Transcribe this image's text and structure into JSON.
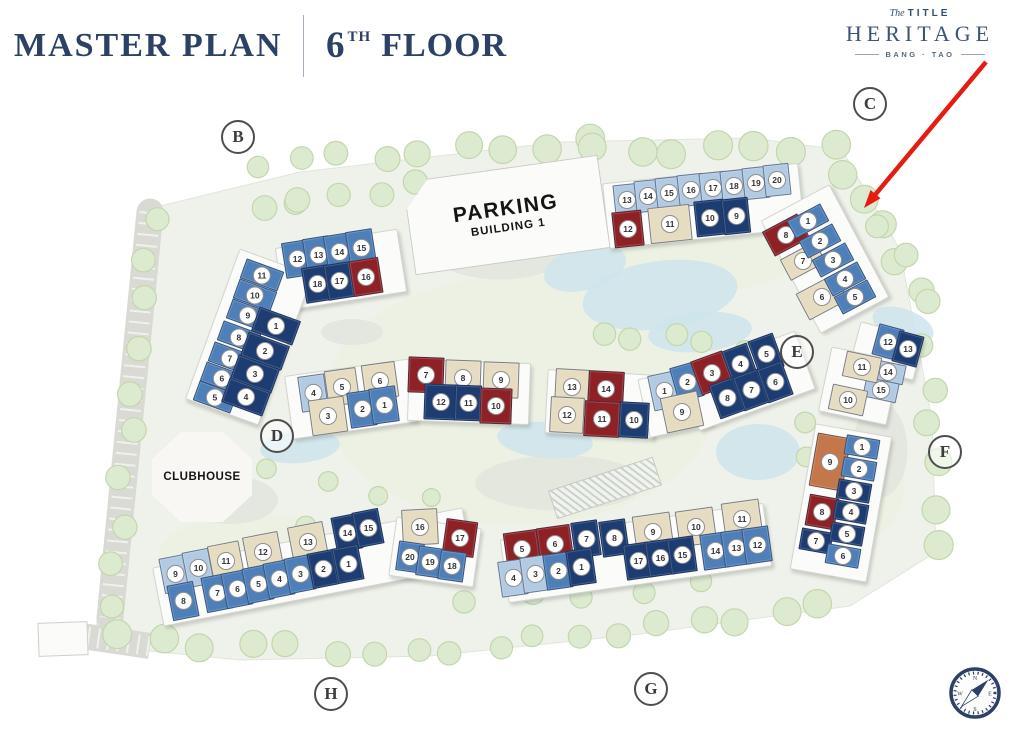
{
  "header": {
    "title": "MASTER PLAN",
    "floor_num": "6",
    "floor_sup": "TH",
    "floor_label": "FLOOR"
  },
  "logo": {
    "prefix": "The",
    "title": "TITLE",
    "name": "HERITAGE",
    "location": "BANG · TAO"
  },
  "site": {
    "parking": {
      "line1": "PARKING",
      "line2": "BUILDING 1"
    },
    "clubhouse": {
      "label": "CLUBHOUSE"
    },
    "status_colors": {
      "lb": "#b3cae3",
      "mb": "#4f7fb8",
      "db": "#1d3c72",
      "rd": "#8e2125",
      "bg": "#e6dcc2",
      "or": "#c3774a"
    },
    "markers": [
      {
        "letter": "B",
        "x": 238,
        "y": 137
      },
      {
        "letter": "C",
        "x": 870,
        "y": 104
      },
      {
        "letter": "D",
        "x": 277,
        "y": 436
      },
      {
        "letter": "E",
        "x": 797,
        "y": 352
      },
      {
        "letter": "F",
        "x": 945,
        "y": 452
      },
      {
        "letter": "G",
        "x": 651,
        "y": 689
      },
      {
        "letter": "H",
        "x": 331,
        "y": 694
      }
    ],
    "annotation_arrow": {
      "from": {
        "x": 986,
        "y": 62
      },
      "to": {
        "x": 864,
        "y": 208
      },
      "color": "#e51c10"
    },
    "compass": {
      "points": [
        "N",
        "E",
        "S",
        "W"
      ]
    },
    "buildings": [
      {
        "id": "B",
        "units": [
          {
            "n": "12",
            "x": 297,
            "y": 259,
            "c": "mb",
            "r": -9
          },
          {
            "n": "13",
            "x": 318,
            "y": 255,
            "c": "mb",
            "r": -9
          },
          {
            "n": "14",
            "x": 339,
            "y": 252,
            "c": "mb",
            "r": -9
          },
          {
            "n": "15",
            "x": 361,
            "y": 248,
            "c": "mb",
            "r": -9
          },
          {
            "n": "18",
            "x": 317,
            "y": 284,
            "c": "db",
            "r": -9
          },
          {
            "n": "17",
            "x": 339,
            "y": 281,
            "c": "db",
            "r": -9
          },
          {
            "n": "16",
            "x": 366,
            "y": 277,
            "c": "rd",
            "r": -9,
            "w": 30
          },
          {
            "n": "11",
            "x": 262,
            "y": 275,
            "c": "mb",
            "r": 20,
            "w": 40,
            "h": 21
          },
          {
            "n": "10",
            "x": 255,
            "y": 295,
            "c": "mb",
            "r": 20,
            "w": 40,
            "h": 21
          },
          {
            "n": "9",
            "x": 248,
            "y": 315,
            "c": "mb",
            "r": 20,
            "w": 40,
            "h": 21
          },
          {
            "n": "8",
            "x": 239,
            "y": 337,
            "c": "mb",
            "r": 20,
            "w": 40,
            "h": 21
          },
          {
            "n": "7",
            "x": 230,
            "y": 358,
            "c": "mb",
            "r": 20,
            "w": 40,
            "h": 21
          },
          {
            "n": "6",
            "x": 222,
            "y": 378,
            "c": "mb",
            "r": 20,
            "w": 40,
            "h": 21
          },
          {
            "n": "5",
            "x": 215,
            "y": 397,
            "c": "mb",
            "r": 20,
            "w": 40,
            "h": 21
          },
          {
            "n": "1",
            "x": 276,
            "y": 326,
            "c": "db",
            "r": 20,
            "w": 44,
            "h": 26
          },
          {
            "n": "2",
            "x": 265,
            "y": 351,
            "c": "db",
            "r": 20,
            "w": 44,
            "h": 26
          },
          {
            "n": "3",
            "x": 255,
            "y": 374,
            "c": "db",
            "r": 20,
            "w": 44,
            "h": 26
          },
          {
            "n": "4",
            "x": 246,
            "y": 397,
            "c": "db",
            "r": 20,
            "w": 44,
            "h": 26
          }
        ]
      },
      {
        "id": "C",
        "units": [
          {
            "n": "13",
            "x": 627,
            "y": 200,
            "c": "lb",
            "r": -6,
            "w": 26,
            "h": 32
          },
          {
            "n": "14",
            "x": 648,
            "y": 196,
            "c": "lb",
            "r": -6,
            "w": 26,
            "h": 32
          },
          {
            "n": "15",
            "x": 669,
            "y": 193,
            "c": "lb",
            "r": -6,
            "w": 26,
            "h": 32
          },
          {
            "n": "16",
            "x": 691,
            "y": 190,
            "c": "lb",
            "r": -6,
            "w": 26,
            "h": 32
          },
          {
            "n": "17",
            "x": 713,
            "y": 188,
            "c": "lb",
            "r": -6,
            "w": 26,
            "h": 32
          },
          {
            "n": "18",
            "x": 734,
            "y": 186,
            "c": "lb",
            "r": -6,
            "w": 26,
            "h": 32
          },
          {
            "n": "19",
            "x": 756,
            "y": 183,
            "c": "lb",
            "r": -6,
            "w": 26,
            "h": 32
          },
          {
            "n": "20",
            "x": 777,
            "y": 180,
            "c": "lb",
            "r": -6,
            "w": 26,
            "h": 32
          },
          {
            "n": "12",
            "x": 628,
            "y": 229,
            "c": "rd",
            "r": -6,
            "w": 30
          },
          {
            "n": "11",
            "x": 670,
            "y": 224,
            "c": "bg",
            "r": -6,
            "w": 42
          },
          {
            "n": "10",
            "x": 710,
            "y": 218,
            "c": "db",
            "r": -6,
            "w": 30
          },
          {
            "n": "9",
            "x": 736,
            "y": 216,
            "c": "db",
            "r": -6
          },
          {
            "n": "8",
            "x": 786,
            "y": 235,
            "c": "rd",
            "r": -28,
            "w": 40,
            "h": 28
          },
          {
            "n": "7",
            "x": 803,
            "y": 261,
            "c": "bg",
            "r": -28,
            "w": 40,
            "h": 24
          },
          {
            "n": "6",
            "x": 822,
            "y": 297,
            "c": "bg",
            "r": -28,
            "w": 44,
            "h": 30
          },
          {
            "n": "1",
            "x": 808,
            "y": 221,
            "c": "mb",
            "r": -28,
            "w": 38,
            "h": 20
          },
          {
            "n": "2",
            "x": 820,
            "y": 241,
            "c": "mb",
            "r": -28,
            "w": 38,
            "h": 20
          },
          {
            "n": "3",
            "x": 833,
            "y": 260,
            "c": "mb",
            "r": -28,
            "w": 38,
            "h": 20
          },
          {
            "n": "4",
            "x": 845,
            "y": 279,
            "c": "mb",
            "r": -28,
            "w": 38,
            "h": 20
          },
          {
            "n": "5",
            "x": 855,
            "y": 297,
            "c": "mb",
            "r": -28,
            "w": 38,
            "h": 20
          }
        ]
      },
      {
        "id": "D",
        "units": [
          {
            "n": "4",
            "x": 313,
            "y": 393,
            "c": "lb",
            "r": -8
          },
          {
            "n": "5",
            "x": 342,
            "y": 387,
            "c": "bg",
            "r": -8,
            "w": 32
          },
          {
            "n": "6",
            "x": 380,
            "y": 381,
            "c": "bg",
            "r": -8,
            "w": 34
          },
          {
            "n": "7",
            "x": 426,
            "y": 375,
            "c": "rd",
            "r": 2,
            "w": 36
          },
          {
            "n": "8",
            "x": 463,
            "y": 378,
            "c": "bg",
            "r": 2,
            "w": 36
          },
          {
            "n": "9",
            "x": 501,
            "y": 380,
            "c": "bg",
            "r": 2,
            "w": 36
          },
          {
            "n": "3",
            "x": 328,
            "y": 416,
            "c": "bg",
            "r": -8,
            "w": 36
          },
          {
            "n": "2",
            "x": 362,
            "y": 409,
            "c": "mb",
            "r": -8
          },
          {
            "n": "1",
            "x": 384,
            "y": 405,
            "c": "mb",
            "r": -8
          },
          {
            "n": "12",
            "x": 441,
            "y": 402,
            "c": "db",
            "r": 2,
            "w": 34
          },
          {
            "n": "11",
            "x": 468,
            "y": 403,
            "c": "db",
            "r": 2
          },
          {
            "n": "10",
            "x": 496,
            "y": 406,
            "c": "rd",
            "r": 2,
            "w": 32
          }
        ]
      },
      {
        "id": "E",
        "units": [
          {
            "n": "13",
            "x": 572,
            "y": 387,
            "c": "bg",
            "r": 3,
            "w": 34
          },
          {
            "n": "14",
            "x": 606,
            "y": 389,
            "c": "rd",
            "r": 3,
            "w": 36
          },
          {
            "n": "1",
            "x": 664,
            "y": 391,
            "c": "lb",
            "r": -12
          },
          {
            "n": "2",
            "x": 687,
            "y": 382,
            "c": "mb",
            "r": -16
          },
          {
            "n": "3",
            "x": 712,
            "y": 373,
            "c": "rd",
            "r": -20,
            "w": 34
          },
          {
            "n": "4",
            "x": 740,
            "y": 364,
            "c": "db",
            "r": -20
          },
          {
            "n": "5",
            "x": 766,
            "y": 354,
            "c": "db",
            "r": -20
          },
          {
            "n": "12",
            "x": 567,
            "y": 415,
            "c": "bg",
            "r": 3,
            "w": 34
          },
          {
            "n": "11",
            "x": 602,
            "y": 419,
            "c": "rd",
            "r": 3,
            "w": 36
          },
          {
            "n": "10",
            "x": 634,
            "y": 420,
            "c": "db",
            "r": 3,
            "w": 30
          },
          {
            "n": "9",
            "x": 682,
            "y": 412,
            "c": "bg",
            "r": -12,
            "w": 38
          },
          {
            "n": "8",
            "x": 727,
            "y": 398,
            "c": "db",
            "r": -20
          },
          {
            "n": "7",
            "x": 751,
            "y": 390,
            "c": "db",
            "r": -20
          },
          {
            "n": "6",
            "x": 775,
            "y": 382,
            "c": "db",
            "r": -20
          }
        ]
      },
      {
        "id": "F",
        "units": [
          {
            "n": "12",
            "x": 888,
            "y": 342,
            "c": "mb",
            "r": 15,
            "w": 26,
            "h": 32
          },
          {
            "n": "13",
            "x": 908,
            "y": 349,
            "c": "db",
            "r": 15,
            "w": 26,
            "h": 32
          },
          {
            "n": "14",
            "x": 888,
            "y": 372,
            "c": "lb",
            "r": 12,
            "w": 34,
            "h": 20
          },
          {
            "n": "15",
            "x": 881,
            "y": 390,
            "c": "lb",
            "r": 12,
            "w": 34,
            "h": 20
          },
          {
            "n": "11",
            "x": 862,
            "y": 367,
            "c": "bg",
            "r": 12,
            "w": 36,
            "h": 26
          },
          {
            "n": "10",
            "x": 848,
            "y": 400,
            "c": "bg",
            "r": 12,
            "w": 36,
            "h": 26
          },
          {
            "n": "9",
            "x": 830,
            "y": 462,
            "c": "or",
            "r": 10,
            "w": 34,
            "h": 54
          },
          {
            "n": "8",
            "x": 822,
            "y": 512,
            "c": "rd",
            "r": 10,
            "w": 30,
            "h": 32
          },
          {
            "n": "7",
            "x": 816,
            "y": 541,
            "c": "db",
            "r": 10,
            "w": 32,
            "h": 22
          },
          {
            "n": "1",
            "x": 862,
            "y": 447,
            "c": "mb",
            "r": 10,
            "w": 34,
            "h": 20
          },
          {
            "n": "2",
            "x": 859,
            "y": 469,
            "c": "mb",
            "r": 10,
            "w": 34,
            "h": 20
          },
          {
            "n": "3",
            "x": 854,
            "y": 491,
            "c": "db",
            "r": 10,
            "w": 34,
            "h": 20
          },
          {
            "n": "4",
            "x": 851,
            "y": 512,
            "c": "db",
            "r": 10,
            "w": 34,
            "h": 20
          },
          {
            "n": "5",
            "x": 847,
            "y": 534,
            "c": "db",
            "r": 10,
            "w": 34,
            "h": 20
          },
          {
            "n": "6",
            "x": 843,
            "y": 556,
            "c": "mb",
            "r": 10,
            "w": 34,
            "h": 20
          }
        ]
      },
      {
        "id": "G",
        "units": [
          {
            "n": "5",
            "x": 522,
            "y": 549,
            "c": "rd",
            "r": -8,
            "w": 34
          },
          {
            "n": "6",
            "x": 555,
            "y": 544,
            "c": "rd",
            "r": -8,
            "w": 34
          },
          {
            "n": "7",
            "x": 586,
            "y": 539,
            "c": "db",
            "r": -8
          },
          {
            "n": "8",
            "x": 614,
            "y": 538,
            "c": "db",
            "r": -8
          },
          {
            "n": "9",
            "x": 653,
            "y": 532,
            "c": "bg",
            "r": -8,
            "w": 38
          },
          {
            "n": "10",
            "x": 696,
            "y": 527,
            "c": "bg",
            "r": -8,
            "w": 38
          },
          {
            "n": "11",
            "x": 742,
            "y": 519,
            "c": "bg",
            "r": -8,
            "w": 38
          },
          {
            "n": "4",
            "x": 513,
            "y": 578,
            "c": "lb",
            "r": -8
          },
          {
            "n": "3",
            "x": 535,
            "y": 574,
            "c": "lb",
            "r": -8
          },
          {
            "n": "2",
            "x": 558,
            "y": 571,
            "c": "mb",
            "r": -8
          },
          {
            "n": "1",
            "x": 581,
            "y": 567,
            "c": "db",
            "r": -8
          },
          {
            "n": "17",
            "x": 638,
            "y": 561,
            "c": "db",
            "r": -8
          },
          {
            "n": "16",
            "x": 660,
            "y": 558,
            "c": "db",
            "r": -8
          },
          {
            "n": "15",
            "x": 682,
            "y": 555,
            "c": "db",
            "r": -8
          },
          {
            "n": "14",
            "x": 715,
            "y": 551,
            "c": "mb",
            "r": -8
          },
          {
            "n": "13",
            "x": 736,
            "y": 548,
            "c": "mb",
            "r": -8
          },
          {
            "n": "12",
            "x": 757,
            "y": 545,
            "c": "mb",
            "r": -8
          }
        ]
      },
      {
        "id": "H",
        "units": [
          {
            "n": "9",
            "x": 175,
            "y": 574,
            "c": "lb",
            "r": -11
          },
          {
            "n": "10",
            "x": 198,
            "y": 568,
            "c": "lb",
            "r": -11
          },
          {
            "n": "11",
            "x": 226,
            "y": 561,
            "c": "bg",
            "r": -11,
            "w": 32
          },
          {
            "n": "12",
            "x": 263,
            "y": 552,
            "c": "bg",
            "r": -11,
            "w": 36
          },
          {
            "n": "13",
            "x": 308,
            "y": 542,
            "c": "bg",
            "r": -11,
            "w": 36
          },
          {
            "n": "14",
            "x": 347,
            "y": 533,
            "c": "db",
            "r": -11
          },
          {
            "n": "15",
            "x": 368,
            "y": 528,
            "c": "db",
            "r": -11
          },
          {
            "n": "16",
            "x": 420,
            "y": 527,
            "c": "bg",
            "r": -3,
            "w": 36
          },
          {
            "n": "17",
            "x": 460,
            "y": 538,
            "c": "rd",
            "r": 8,
            "w": 32
          },
          {
            "n": "8",
            "x": 183,
            "y": 601,
            "c": "mb",
            "r": -11
          },
          {
            "n": "7",
            "x": 217,
            "y": 593,
            "c": "mb",
            "r": -11
          },
          {
            "n": "6",
            "x": 237,
            "y": 589,
            "c": "mb",
            "r": -11
          },
          {
            "n": "5",
            "x": 258,
            "y": 584,
            "c": "mb",
            "r": -11
          },
          {
            "n": "4",
            "x": 279,
            "y": 579,
            "c": "mb",
            "r": -11
          },
          {
            "n": "3",
            "x": 300,
            "y": 574,
            "c": "mb",
            "r": -11
          },
          {
            "n": "2",
            "x": 323,
            "y": 569,
            "c": "db",
            "r": -11
          },
          {
            "n": "1",
            "x": 348,
            "y": 564,
            "c": "db",
            "r": -11
          },
          {
            "n": "20",
            "x": 410,
            "y": 557,
            "c": "mb",
            "r": 8,
            "w": 26,
            "h": 30
          },
          {
            "n": "19",
            "x": 430,
            "y": 562,
            "c": "mb",
            "r": 8,
            "w": 26,
            "h": 30
          },
          {
            "n": "18",
            "x": 452,
            "y": 566,
            "c": "mb",
            "r": 8,
            "w": 26,
            "h": 30
          }
        ]
      }
    ]
  }
}
